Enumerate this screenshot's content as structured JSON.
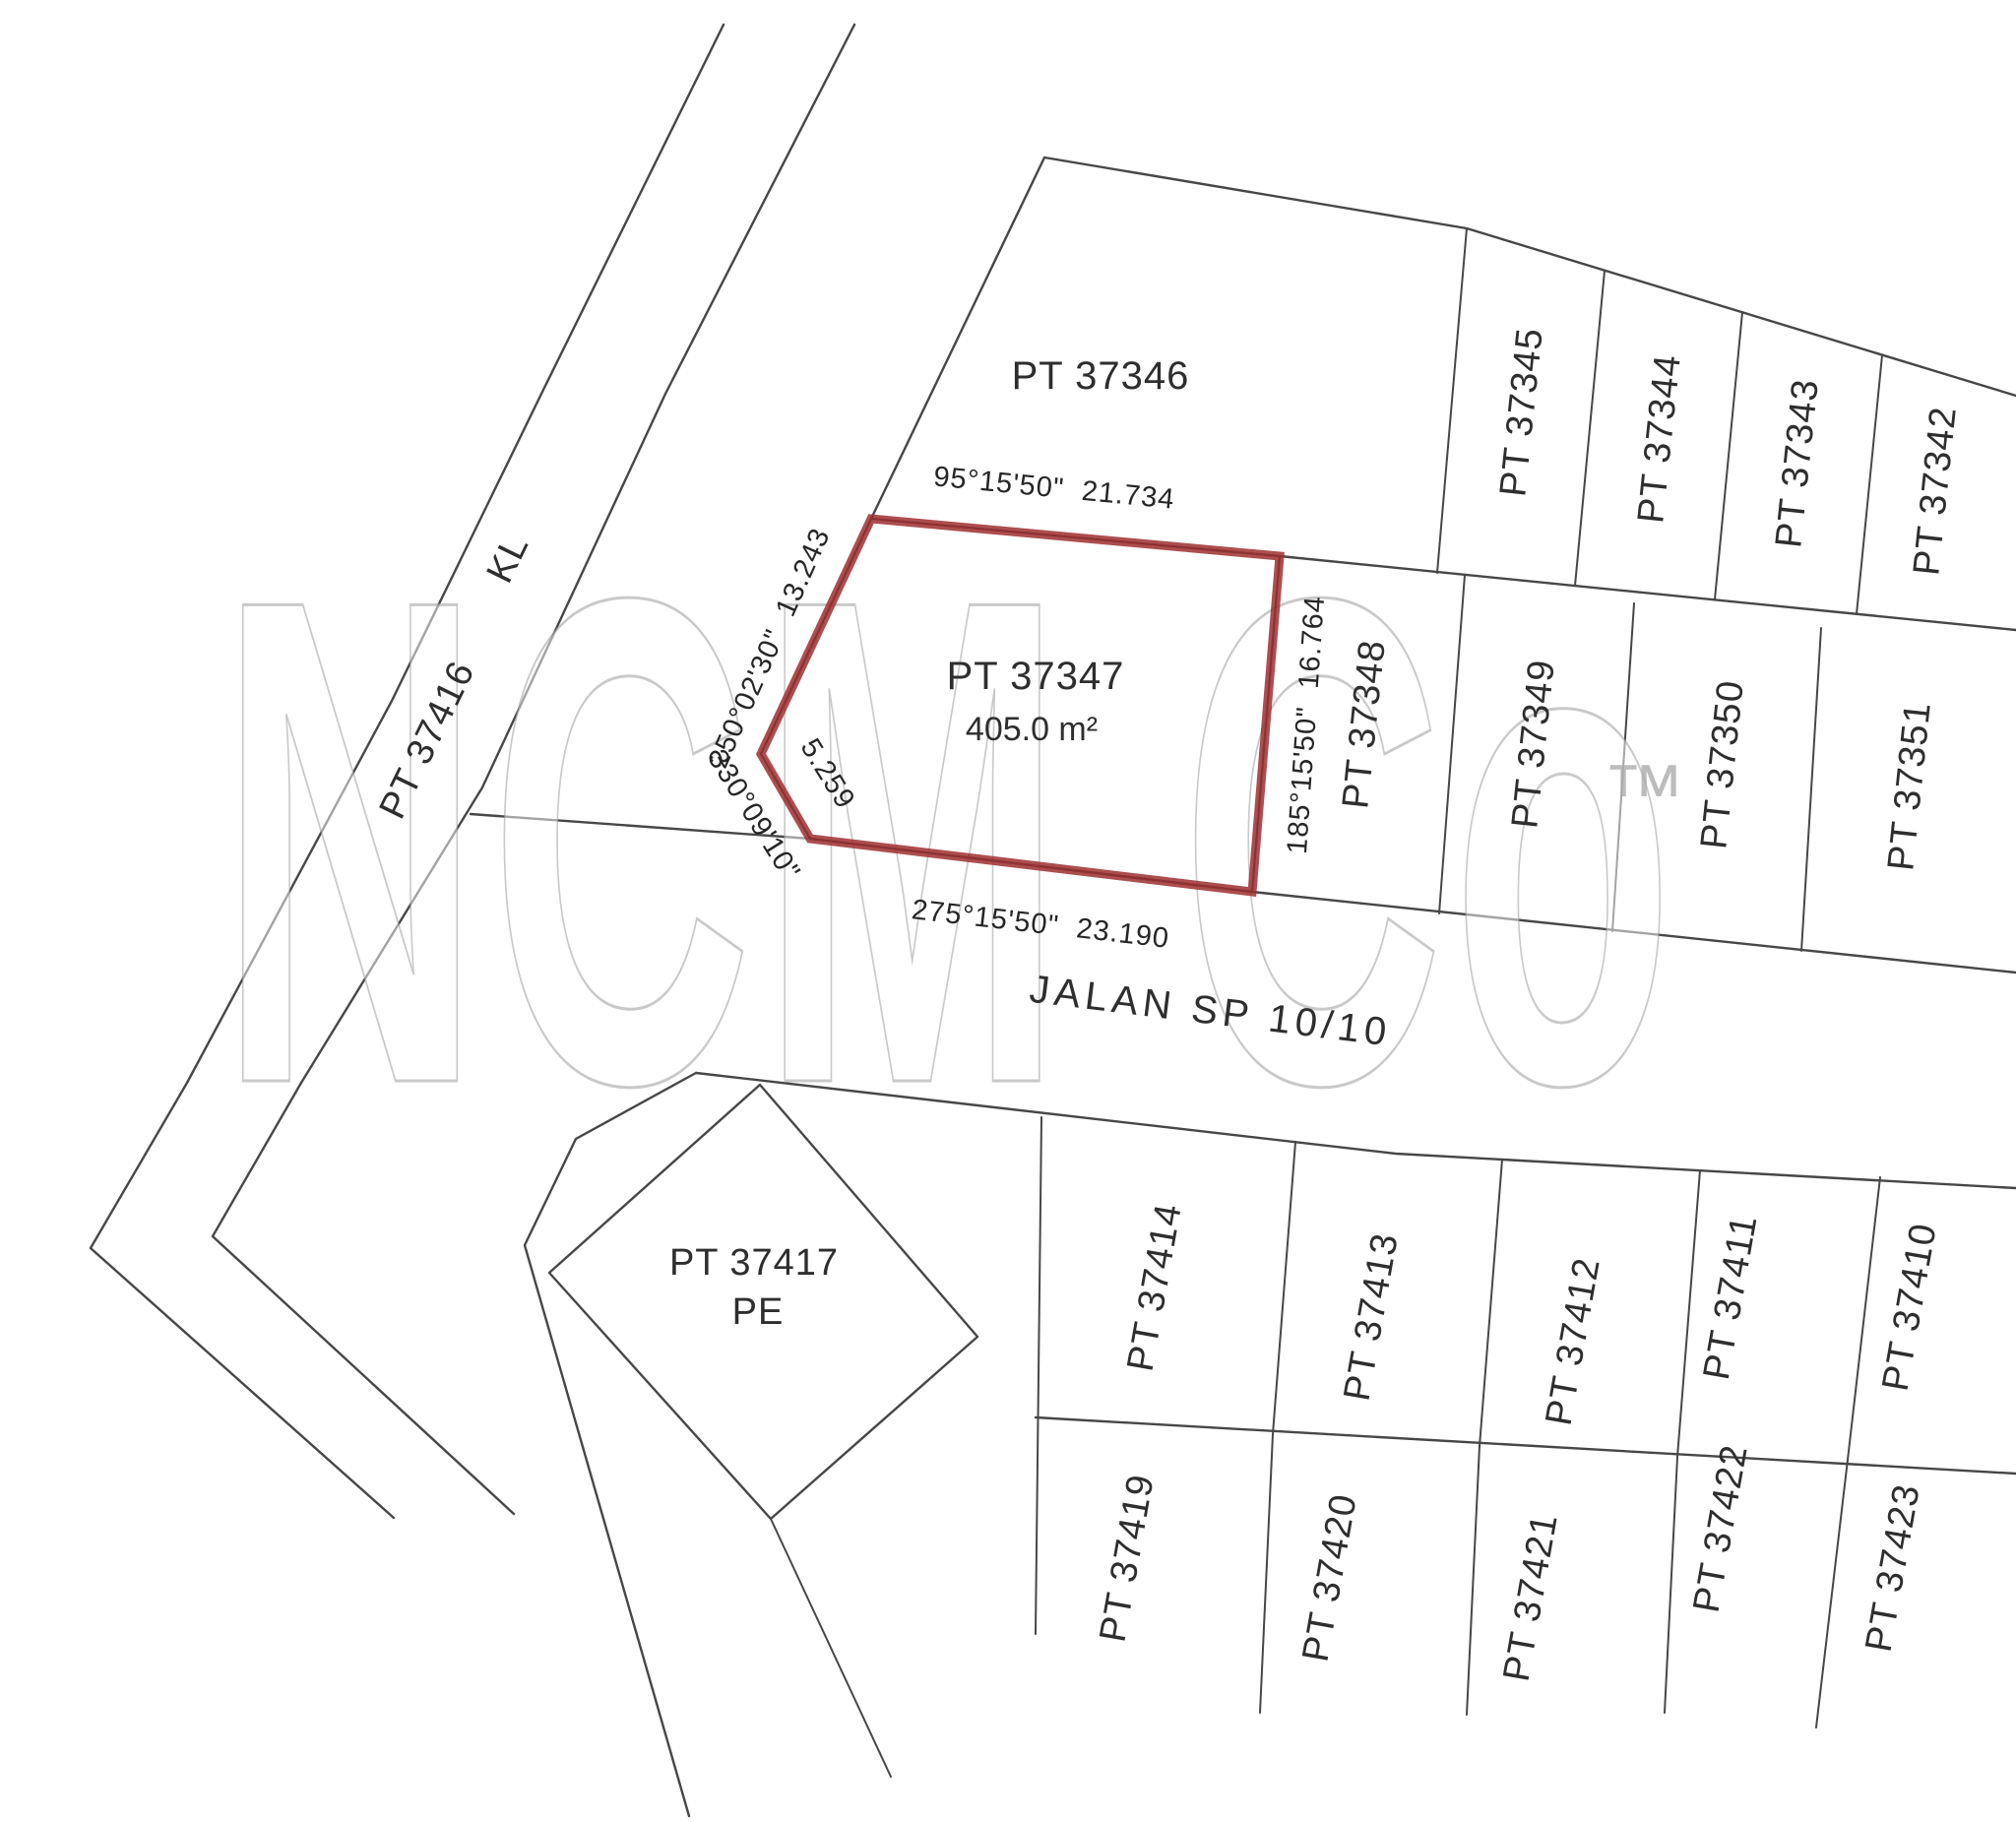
{
  "watermark": {
    "text": "NCM Co",
    "tm": "™"
  },
  "roads": {
    "jalan": "JALAN SP 10/10",
    "kl": "KL"
  },
  "highlight": {
    "id": "PT 37347",
    "area": "405.0 m²",
    "accent_color": "#9e2f30",
    "bearings": {
      "top": "95°15'50\"  21.734",
      "upper_left": "250°02'30\"  13.243",
      "lower_left_angle": "330°09'10\"",
      "lower_left_distance": "5.259",
      "bottom": "275°15'50\"  23.190",
      "right": "185°15'50\"  16.764"
    }
  },
  "plots": {
    "pt37346": "PT 37346",
    "pt37345": "PT 37345",
    "pt37344": "PT 37344",
    "pt37343": "PT 37343",
    "pt37342": "PT 37342",
    "pt37348": "PT 37348",
    "pt37349": "PT 37349",
    "pt37350": "PT 37350",
    "pt37351": "PT 37351",
    "pt37416": "PT 37416",
    "pt37417": "PT 37417",
    "pt37417_code": "PE",
    "pt37414": "PT 37414",
    "pt37413": "PT 37413",
    "pt37412": "PT 37412",
    "pt37411": "PT 37411",
    "pt37410": "PT 37410",
    "pt37419": "PT 37419",
    "pt37420": "PT 37420",
    "pt37421": "PT 37421",
    "pt37422": "PT 37422",
    "pt37423": "PT 37423"
  }
}
